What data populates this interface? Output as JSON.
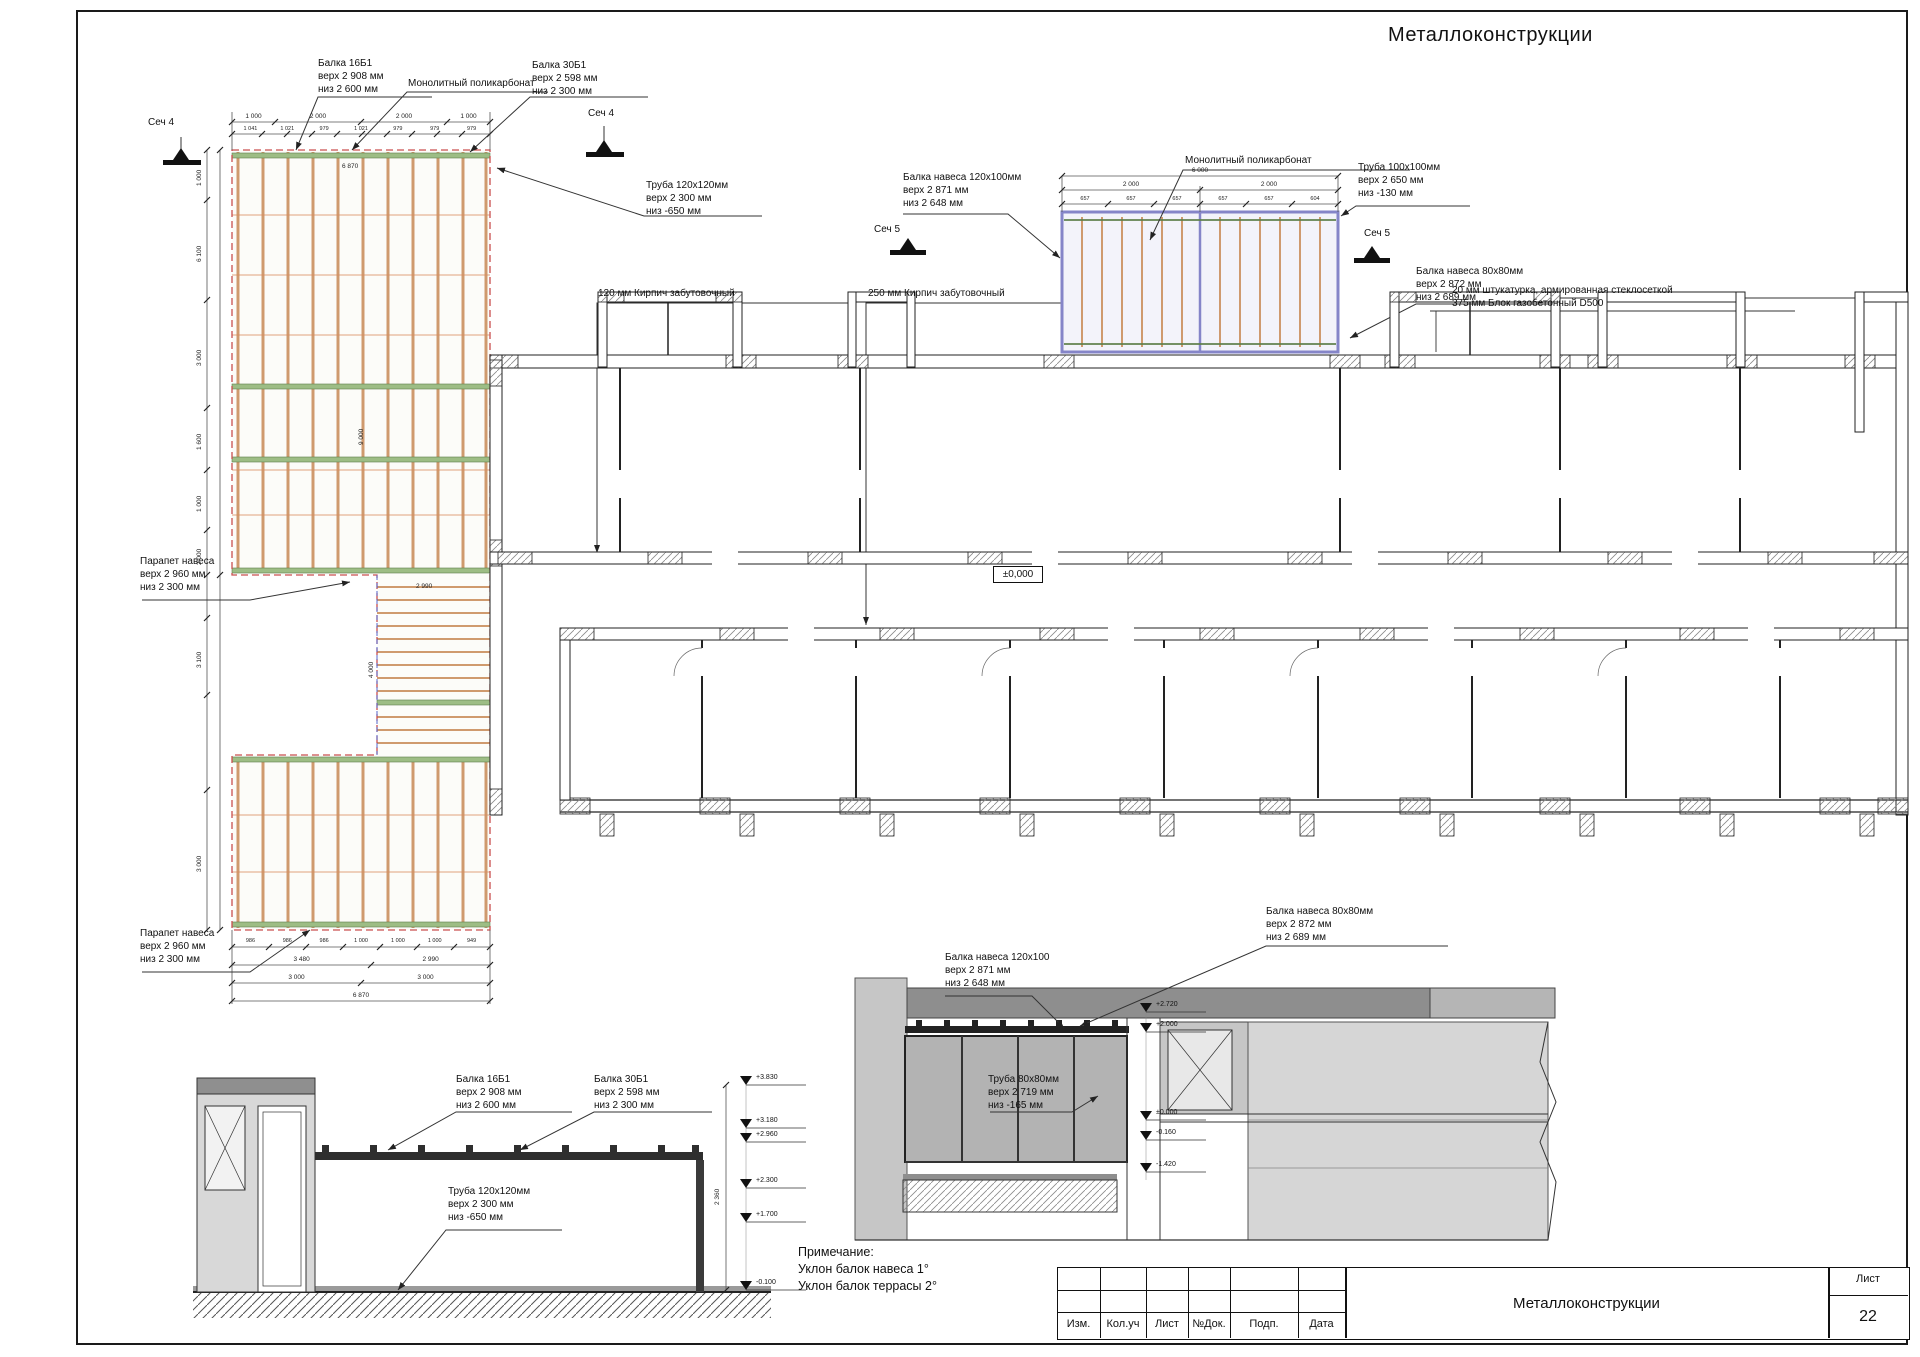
{
  "sheet": {
    "corner_title": "Металлоконструкции",
    "note": {
      "title": "Примечание:",
      "line1": "Уклон балок навеса 1°",
      "line2": "Уклон балок террасы 2°"
    },
    "title_block": {
      "columns": [
        "Изм.",
        "Кол.уч",
        "Лист",
        "№Док.",
        "Подп.",
        "Дата"
      ],
      "doc_title": "Металлоконструкции",
      "sheet_label": "Лист",
      "sheet_number": "22"
    }
  },
  "marks": {
    "sech4": "Сеч 4",
    "sech5": "Сеч 5",
    "level_zero": "±0,000"
  },
  "labels": {
    "balka16b1": [
      "Балка 16Б1",
      "верх 2  908 мм",
      "низ  2  600 мм"
    ],
    "balka30b1": [
      "Балка 30Б1",
      "верх 2  598 мм",
      "низ  2  300 мм"
    ],
    "mono_poly": "Монолитный поликарбонат",
    "truba120": [
      "Труба 120х120мм",
      "верх 2  300 мм",
      "низ  -650 мм"
    ],
    "balka_nav120": [
      "Балка навеса 120х100мм",
      "верх 2  871 мм",
      "низ  2  648 мм"
    ],
    "balka_nav120_short": [
      "Балка навеса 120х100",
      "верх 2  871 мм",
      "низ  2  648 мм"
    ],
    "truba100": [
      "Труба 100х100мм",
      "верх 2  650 мм",
      "низ  -130 мм"
    ],
    "balka_nav80": [
      "Балка навеса 80х80мм",
      "верх 2  872 мм",
      "низ  2  689 мм"
    ],
    "shtukaturka": "20 мм штукатурка, армированная стеклосеткой",
    "gasoblock": "375 мм Блок газобетонный D500",
    "kirpich120": "120 мм  Кирпич забутовочный",
    "kirpich250": "250 мм  Кирпич забутовочный",
    "parapet": [
      "Парапет навеса",
      "верх 2  960 мм",
      "низ  2  300 мм"
    ],
    "truba80": [
      "Труба 80х80мм",
      "верх 2  719 мм",
      "низ  -165 мм"
    ]
  },
  "dims": {
    "canopy_total": "6 000",
    "canopy_halves": [
      "2 000",
      "2 000"
    ],
    "canopy_detail": [
      "657",
      "657",
      "657",
      "657",
      "657",
      "604"
    ],
    "plan_top_row1": [
      "1 000",
      "2 000",
      "2 000",
      "1 000"
    ],
    "plan_top_row2": [
      "1 041",
      "1 021",
      "979",
      "1 021",
      "979",
      "979",
      "979"
    ],
    "plan_top_total": "6 870",
    "plan_left": [
      "1 000",
      "6 100",
      "3 000",
      "1 600",
      "1 000",
      "2 000",
      "3 100",
      "3 000"
    ],
    "plan_inner_v1": "9 000",
    "plan_inner_v2": "4 000",
    "plan_inner_h1": "2 990",
    "plan_bottom_row1": [
      "986",
      "986",
      "986",
      "1 000",
      "1 000",
      "1 000",
      "949"
    ],
    "plan_bottom_row2": [
      "3 480",
      "2 990"
    ],
    "plan_bottom_row3": [
      "3 000",
      "3 000"
    ],
    "plan_bottom_total": "6 870",
    "section4_v": "2 360"
  },
  "elevations": {
    "sech4": [
      "+3.830",
      "+3.180",
      "+2.960",
      "+2.300",
      "+1.700",
      "-0.100"
    ],
    "sech5": [
      "+2.720",
      "+2.000",
      "±0.000",
      "-0.160",
      "-1.420"
    ]
  }
}
